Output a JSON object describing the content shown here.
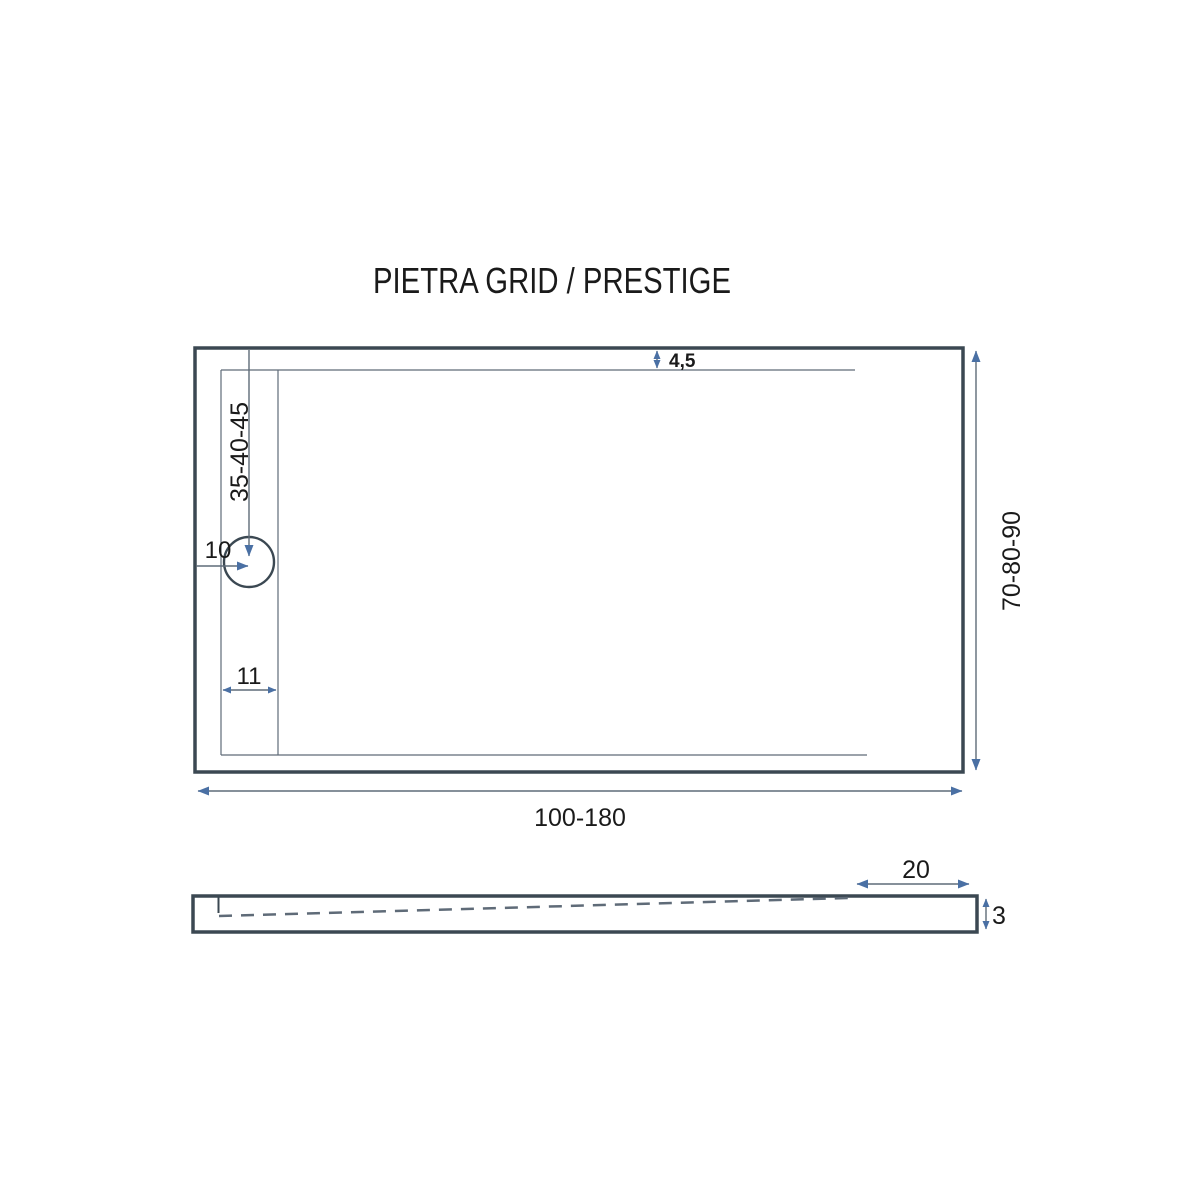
{
  "title": "PIETRA GRID / PRESTIGE",
  "colors": {
    "outline": "#3b4852",
    "thin_line": "#5f6b78",
    "arrow": "#4a70a4",
    "text": "#1a1a1a",
    "background": "#ffffff"
  },
  "top_view": {
    "dimensions": {
      "rim_offset": "4,5",
      "drain_distance_from_top": "35-40-45",
      "drain_distance_from_left": "10",
      "channel_width": "11",
      "length_range": "100-180",
      "width_range": "70-80-90"
    }
  },
  "side_view": {
    "dimensions": {
      "flat_edge_length": "20",
      "edge_thickness": "3"
    }
  }
}
